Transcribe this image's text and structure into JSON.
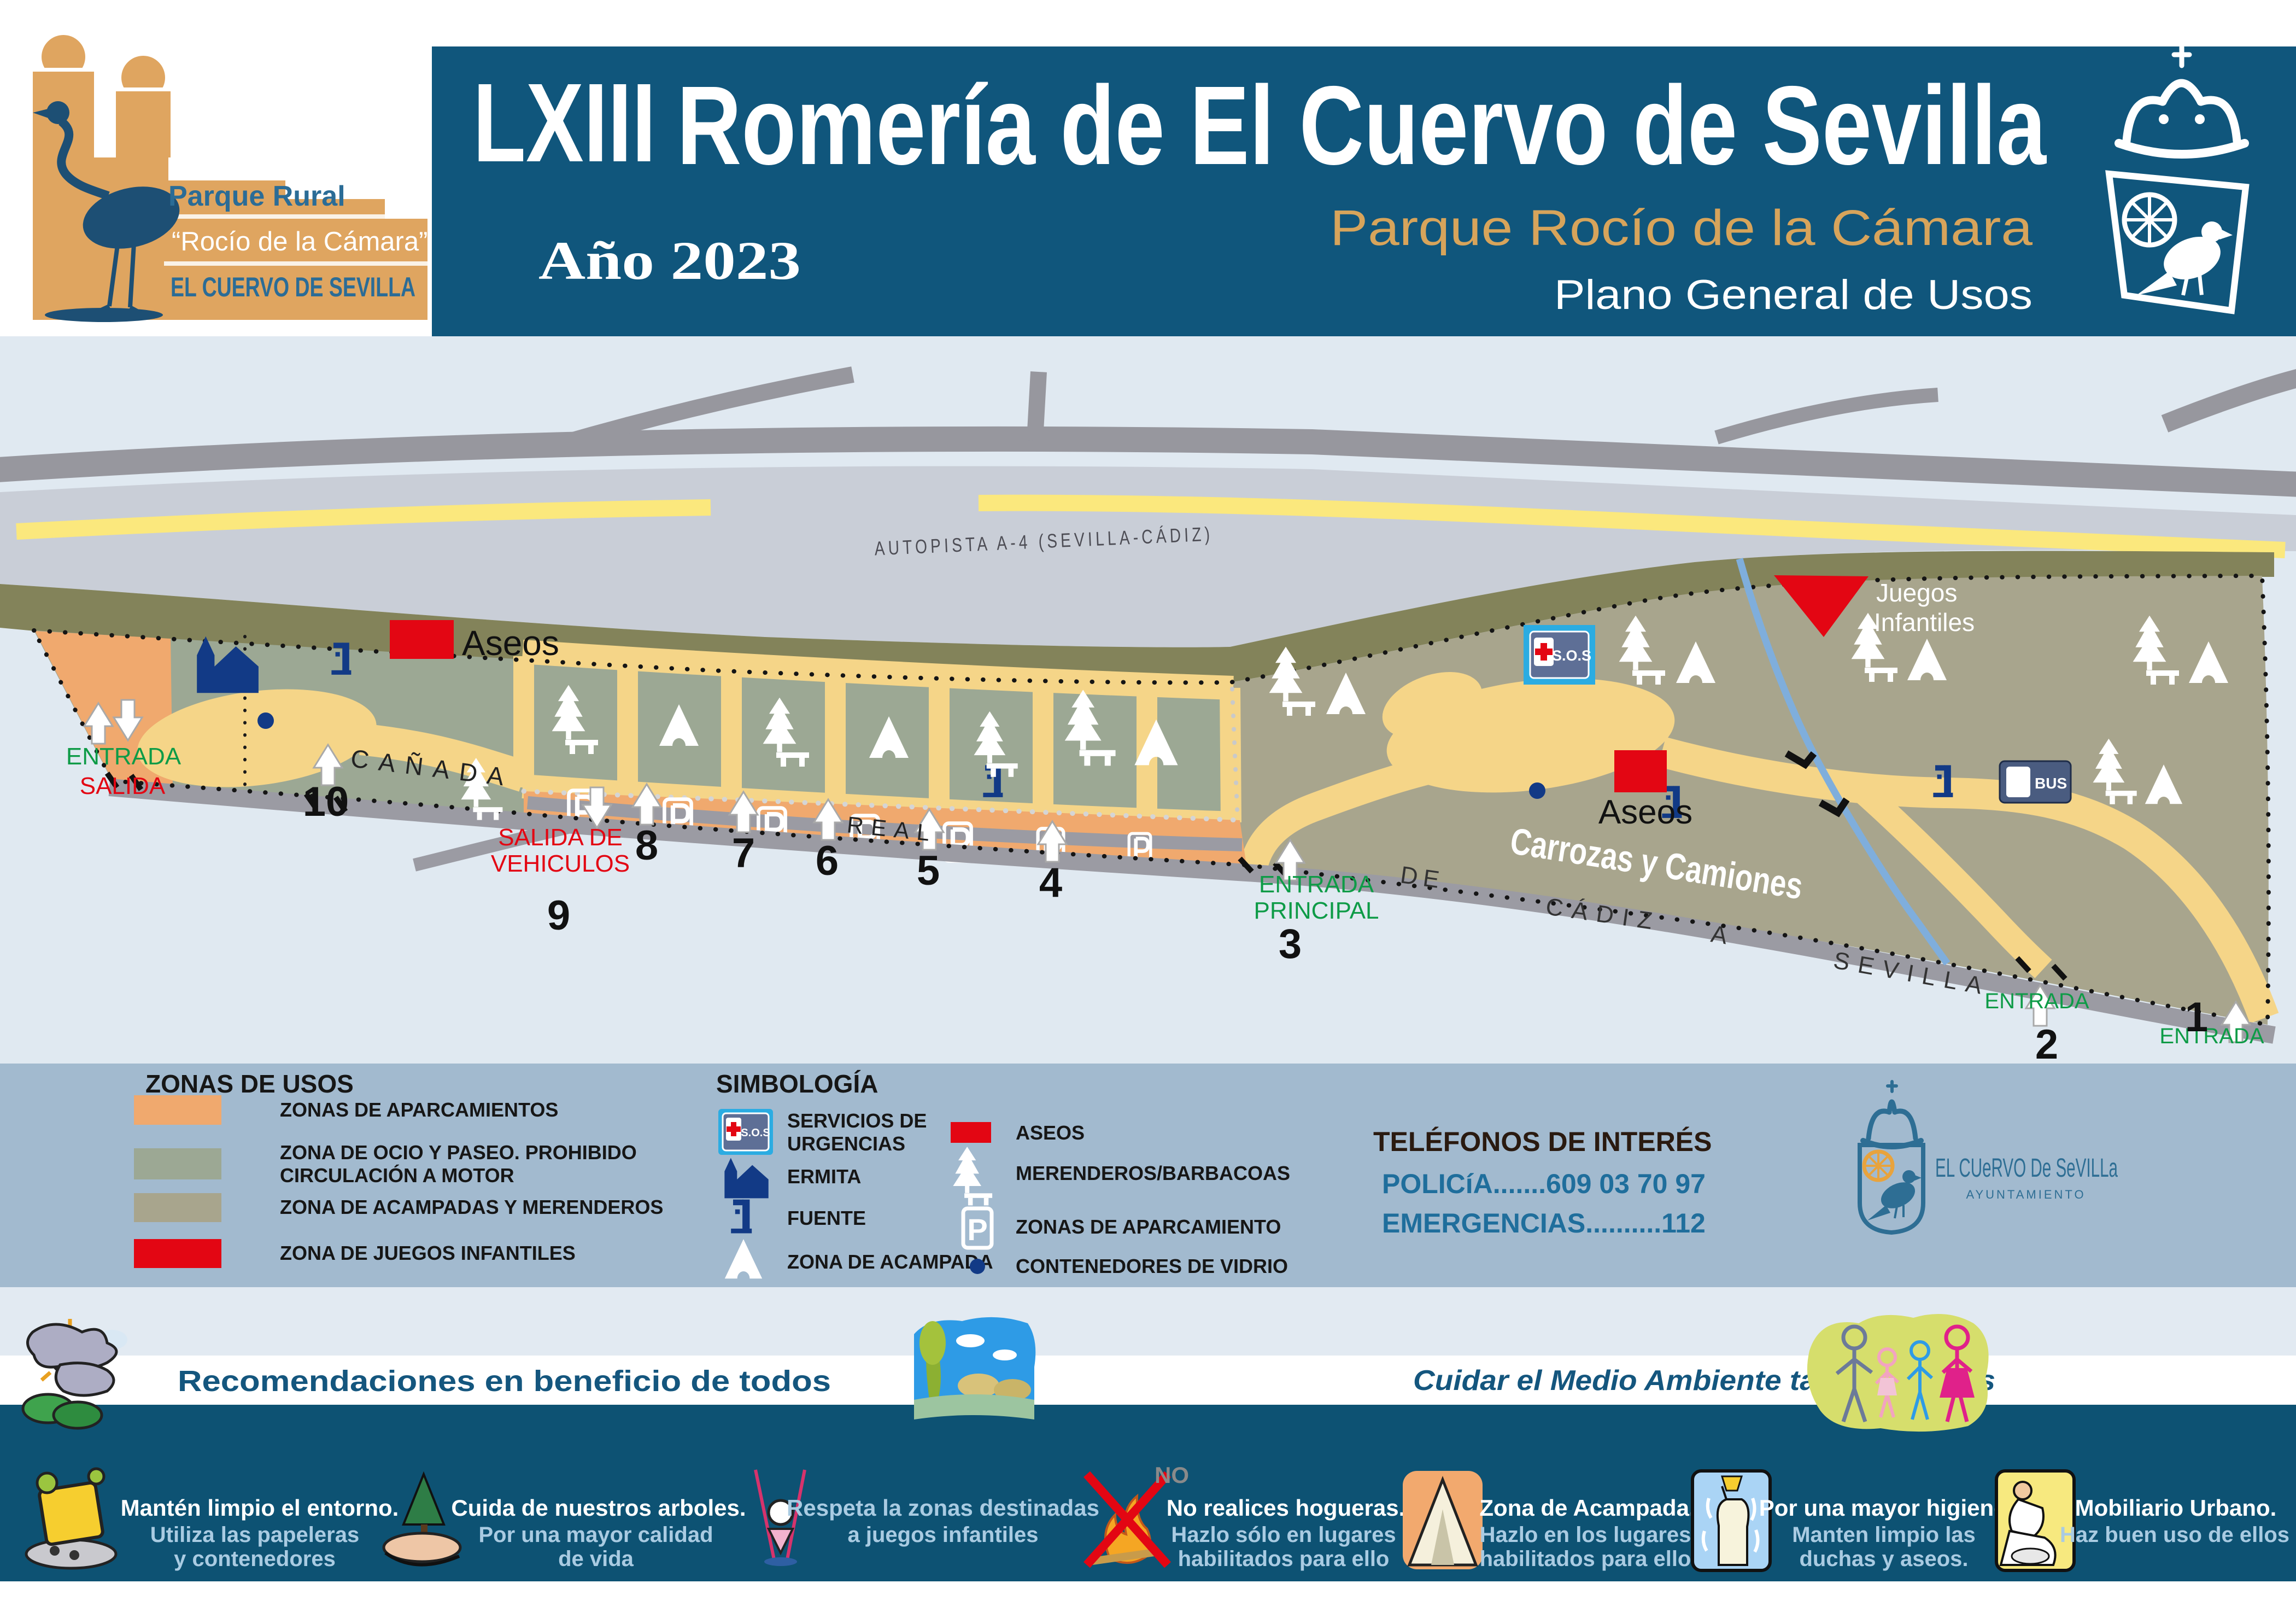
{
  "header": {
    "logo_line1": "Parque Rural",
    "logo_line2": "“Rocío de la Cámara”",
    "logo_line3": "EL CUERVO DE SEVILLA",
    "edition": "LXIII",
    "title": "Romería de El Cuervo de Sevilla",
    "year": "Año 2023",
    "park_name": "Parque Rocío de la Cámara",
    "plan_name": "Plano General de Usos"
  },
  "map": {
    "highway": "AUTOPISTA A-4 (SEVILLA-CÁDIZ)",
    "aseos1": "Aseos",
    "aseos2": "Aseos",
    "entrada": "ENTRADA",
    "salida": "SALIDA",
    "canada": "CAÑADA",
    "real": "REAL",
    "salida_vehiculos_1": "SALIDA DE",
    "salida_vehiculos_2": "VEHICULOS",
    "entrada_principal_1": "ENTRADA",
    "entrada_principal_2": "PRINCIPAL",
    "juegos_1": "Juegos",
    "juegos_2": "Infantiles",
    "carrozas": "Carrozas y Camiones",
    "road_de": "DE",
    "road_cadiz": "CÁDIZ",
    "road_a": "A",
    "road_sevilla": "SEVILLA",
    "entrada_2_label": "ENTRADA",
    "entrada_1_label": "ENTRADA",
    "sos_label": "S.O.S",
    "bus_label": "BUS",
    "numbers": [
      "1",
      "2",
      "3",
      "4",
      "5",
      "6",
      "7",
      "8",
      "9",
      "10"
    ]
  },
  "icons": {
    "parking_letter": "P"
  },
  "legend": {
    "zones_title": "ZONAS DE USOS",
    "zones": [
      {
        "color": "#F0A96E",
        "label": "ZONAS DE APARCAMIENTOS",
        "label2": ""
      },
      {
        "color": "#9CA894",
        "label": "ZONA DE OCIO Y PASEO. PROHIBIDO",
        "label2": "CIRCULACIÓN A MOTOR"
      },
      {
        "color": "#A8A58D",
        "label": "ZONA DE ACAMPADAS Y MERENDEROS",
        "label2": ""
      },
      {
        "color": "#E30613",
        "label": "ZONA DE JUEGOS INFANTILES",
        "label2": ""
      }
    ],
    "symbols_title": "SIMBOLOGÍA",
    "symbols_left": [
      {
        "label": "SERVICIOS DE",
        "label2": "URGENCIAS"
      },
      {
        "label": "ERMITA"
      },
      {
        "label": "FUENTE"
      },
      {
        "label": "ZONA DE ACAMPADA"
      }
    ],
    "symbols_right": [
      {
        "label": "ASEOS"
      },
      {
        "label": "MERENDEROS/BARBACOAS"
      },
      {
        "label": "ZONAS DE APARCAMIENTO"
      },
      {
        "label": "CONTENEDORES DE VIDRIO"
      }
    ],
    "phones_title": "TELÉFONOS DE INTERÉS",
    "phone1": "POLICíA.......609 03 70 97",
    "phone2": "EMERGENCIAS..........112",
    "municipality_name": "EL CUeRVO De SeVILLa",
    "municipality_sub": "AYUNTAMIENTO"
  },
  "recommendations": {
    "left_banner": "Recomendaciones en beneficio de todos",
    "right_banner": "Cuidar el Medio Ambiente tarea de todos",
    "no_label": "NO",
    "items": [
      {
        "title": "Mantén limpio el entorno.",
        "line1": "Utiliza las papeleras",
        "line2": "y contenedores"
      },
      {
        "title": "Cuida de nuestros arboles.",
        "line1": "Por una mayor calidad",
        "line2": "de vida"
      },
      {
        "title": "Respeta la zonas destinadas",
        "line1": "a juegos infantiles",
        "line2": ""
      },
      {
        "title": "No realices hogueras.",
        "line1": "Hazlo sólo en lugares",
        "line2": "habilitados para ello"
      },
      {
        "title": "Zona de Acampada.",
        "line1": "Hazlo en los lugares",
        "line2": "habilitados para ello"
      },
      {
        "title": "Por una mayor higiene.",
        "line1": "Manten limpio las",
        "line2": "duchas y aseos."
      },
      {
        "title": "Mobiliario Urbano.",
        "line1": "Haz buen uso de ellos",
        "line2": ""
      }
    ]
  },
  "colors": {
    "header_blue": "#10567C",
    "band_blue": "#0D5273",
    "legend_band": "#A2BACF",
    "map_bg": "#E0E9F1",
    "park_green": "#9CA894",
    "park_tan": "#A8A58D",
    "parking_orange": "#F0A96E",
    "path_yellow": "#F5D588",
    "accent_red": "#E30613",
    "tan_text": "#D7A45B",
    "icon_navy": "#123A86",
    "subtitle_blue": "#A9CBE2"
  }
}
